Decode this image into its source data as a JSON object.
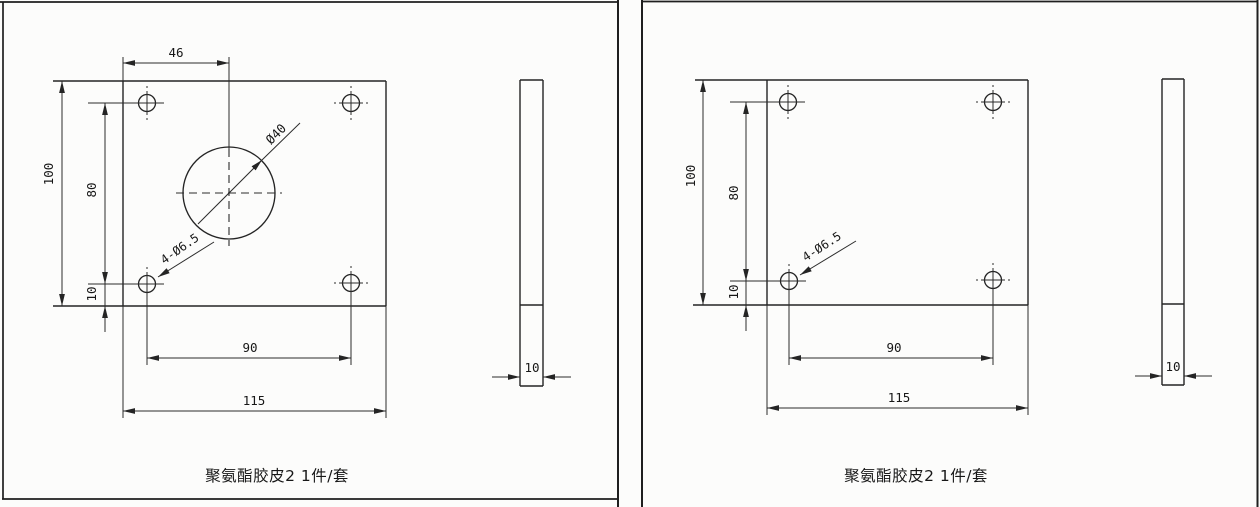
{
  "document_type": "engineering-drawing-scan",
  "colors": {
    "paper": "#fcfcfb",
    "line": "#242424",
    "text": "#171717"
  },
  "left_sheet": {
    "caption": "聚氨酯胶皮2 1件/套",
    "front_view": {
      "dims": {
        "hole_center_from_left_edge": "46",
        "plate_height": "100",
        "hole_span_vertical": "80",
        "hole_edge_offset": "10",
        "hole_span_horizontal": "90",
        "plate_width": "115",
        "center_hole_diameter": "Ø40",
        "corner_holes_callout": "4-Ø6.5"
      }
    },
    "side_view": {
      "dims": {
        "thickness": "10"
      }
    }
  },
  "right_sheet": {
    "caption": "聚氨酯胶皮2 1件/套",
    "front_view": {
      "dims": {
        "plate_height": "100",
        "hole_span_vertical": "80",
        "hole_edge_offset": "10",
        "hole_span_horizontal": "90",
        "plate_width": "115",
        "corner_holes_callout": "4-Ø6.5"
      }
    },
    "side_view": {
      "dims": {
        "thickness": "10"
      }
    }
  }
}
